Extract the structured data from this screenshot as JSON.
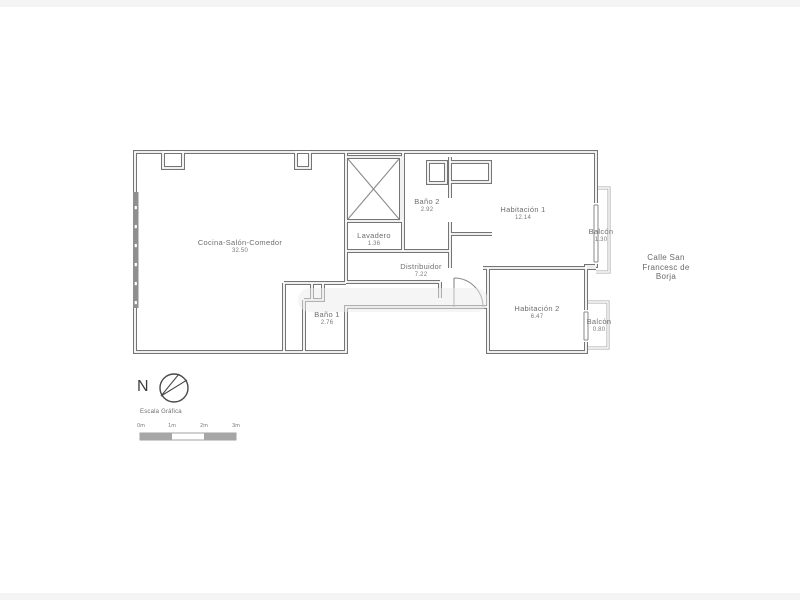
{
  "floor_plan": {
    "rooms": [
      {
        "name": "Cocina-Salón-Comedor",
        "area": "32.50"
      },
      {
        "name": "Baño 2",
        "area": "2.92"
      },
      {
        "name": "Lavadero",
        "area": "1.36"
      },
      {
        "name": "Habitación 1",
        "area": "12.14"
      },
      {
        "name": "Distribuidor",
        "area": "7.22"
      },
      {
        "name": "Baño 1",
        "area": "2.76"
      },
      {
        "name": "Habitación 2",
        "area": "6.47"
      },
      {
        "name": "Balcón",
        "area": "1.30"
      },
      {
        "name": "Balcón",
        "area": "0.80"
      }
    ],
    "street": {
      "lines": [
        "Calle San",
        "Francesc de",
        "Borja"
      ]
    },
    "compass_label": "N",
    "scale_bar": {
      "title": "Escala Gráfica",
      "ticks": [
        "0m",
        "1m",
        "2m",
        "3m"
      ]
    },
    "colors": {
      "wall": "#757575",
      "balcony_wall": "#a9a9a9",
      "text": "#6e6e6e"
    }
  }
}
